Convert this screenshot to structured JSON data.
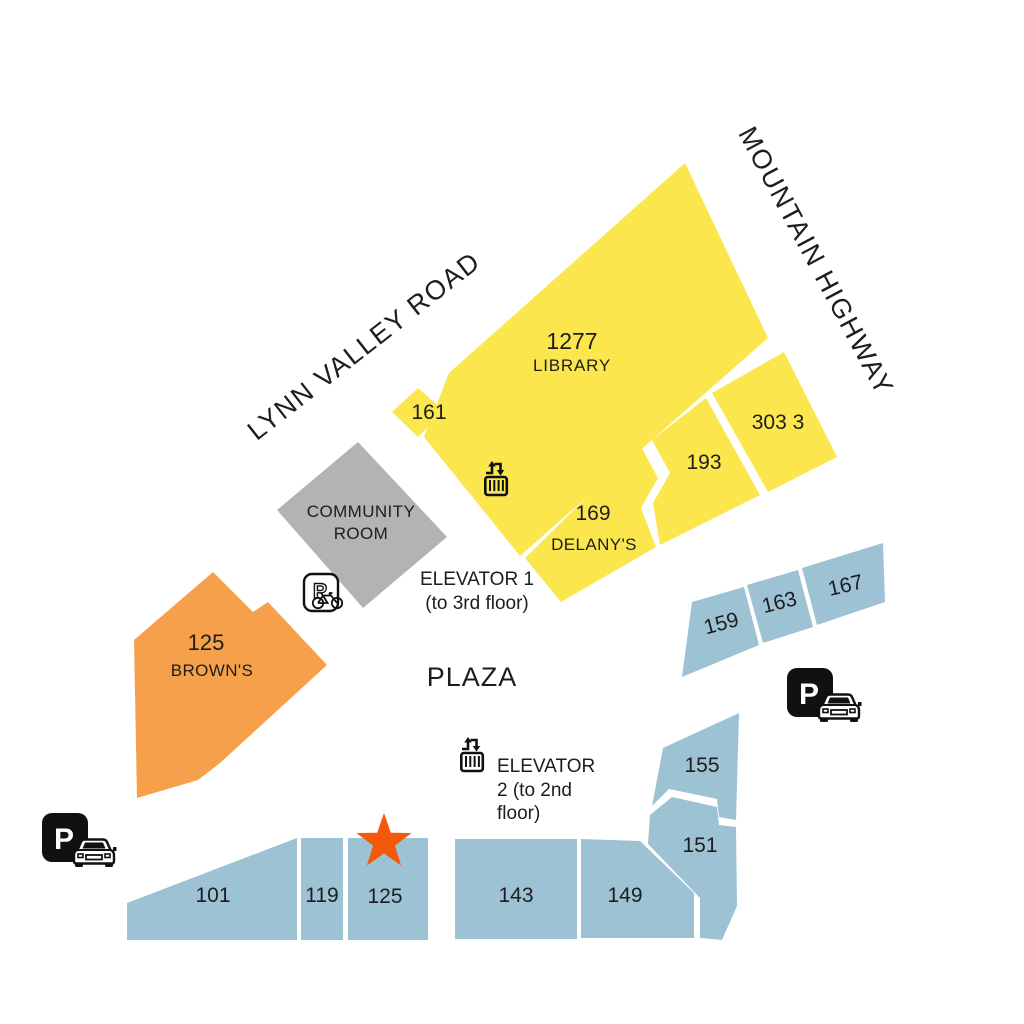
{
  "streets": {
    "lynn_valley_road": "LYNN VALLEY ROAD",
    "mountain_highway": "MOUNTAIN HIGHWAY"
  },
  "plaza": {
    "label": "PLAZA"
  },
  "buildings": {
    "library": {
      "number": "1277",
      "name": "LIBRARY",
      "color": "yellow"
    },
    "unit_161": {
      "number": "161",
      "color": "yellow"
    },
    "delanys": {
      "number": "169",
      "name": "DELANY'S",
      "color": "yellow"
    },
    "unit_193": {
      "number": "193",
      "color": "yellow"
    },
    "unit_3033": {
      "number": "303 3",
      "color": "yellow"
    },
    "community_room": {
      "name_line1": "COMMUNITY",
      "name_line2": "ROOM",
      "color": "gray"
    },
    "browns": {
      "number": "125",
      "name": "BROWN'S",
      "color": "orange"
    },
    "unit_159": {
      "number": "159",
      "color": "blue"
    },
    "unit_163": {
      "number": "163",
      "color": "blue"
    },
    "unit_167": {
      "number": "167",
      "color": "blue"
    },
    "unit_155": {
      "number": "155",
      "color": "blue"
    },
    "unit_151": {
      "number": "151",
      "color": "blue"
    },
    "unit_101": {
      "number": "101",
      "color": "blue"
    },
    "unit_119": {
      "number": "119",
      "color": "blue"
    },
    "unit_125": {
      "number": "125",
      "color": "blue"
    },
    "unit_143": {
      "number": "143",
      "color": "blue"
    },
    "unit_149": {
      "number": "149",
      "color": "blue"
    }
  },
  "elevators": {
    "elevator_1": {
      "line1": "ELEVATOR 1",
      "line2": "(to 3rd floor)"
    },
    "elevator_2": {
      "line1": "ELEVATOR",
      "line2": "2 (to 2nd",
      "line3": "floor)"
    }
  },
  "parking": {
    "letter": "P"
  },
  "icons": {
    "elevator_1": "elevator-icon",
    "elevator_2": "elevator-icon",
    "parking_bike": "parking-bike-icon",
    "parking_car_left": "parking-car-icon",
    "parking_car_right": "parking-car-icon",
    "location_marker": "star-icon"
  },
  "colors": {
    "yellow": "#FBE74D",
    "blue": "#9DC2D4",
    "orange": "#F7A04B",
    "gray": "#B3B3B3",
    "star": "#F4580A",
    "icon_black": "#111111",
    "text": "#1D1D1D",
    "background": "#FFFFFF"
  }
}
